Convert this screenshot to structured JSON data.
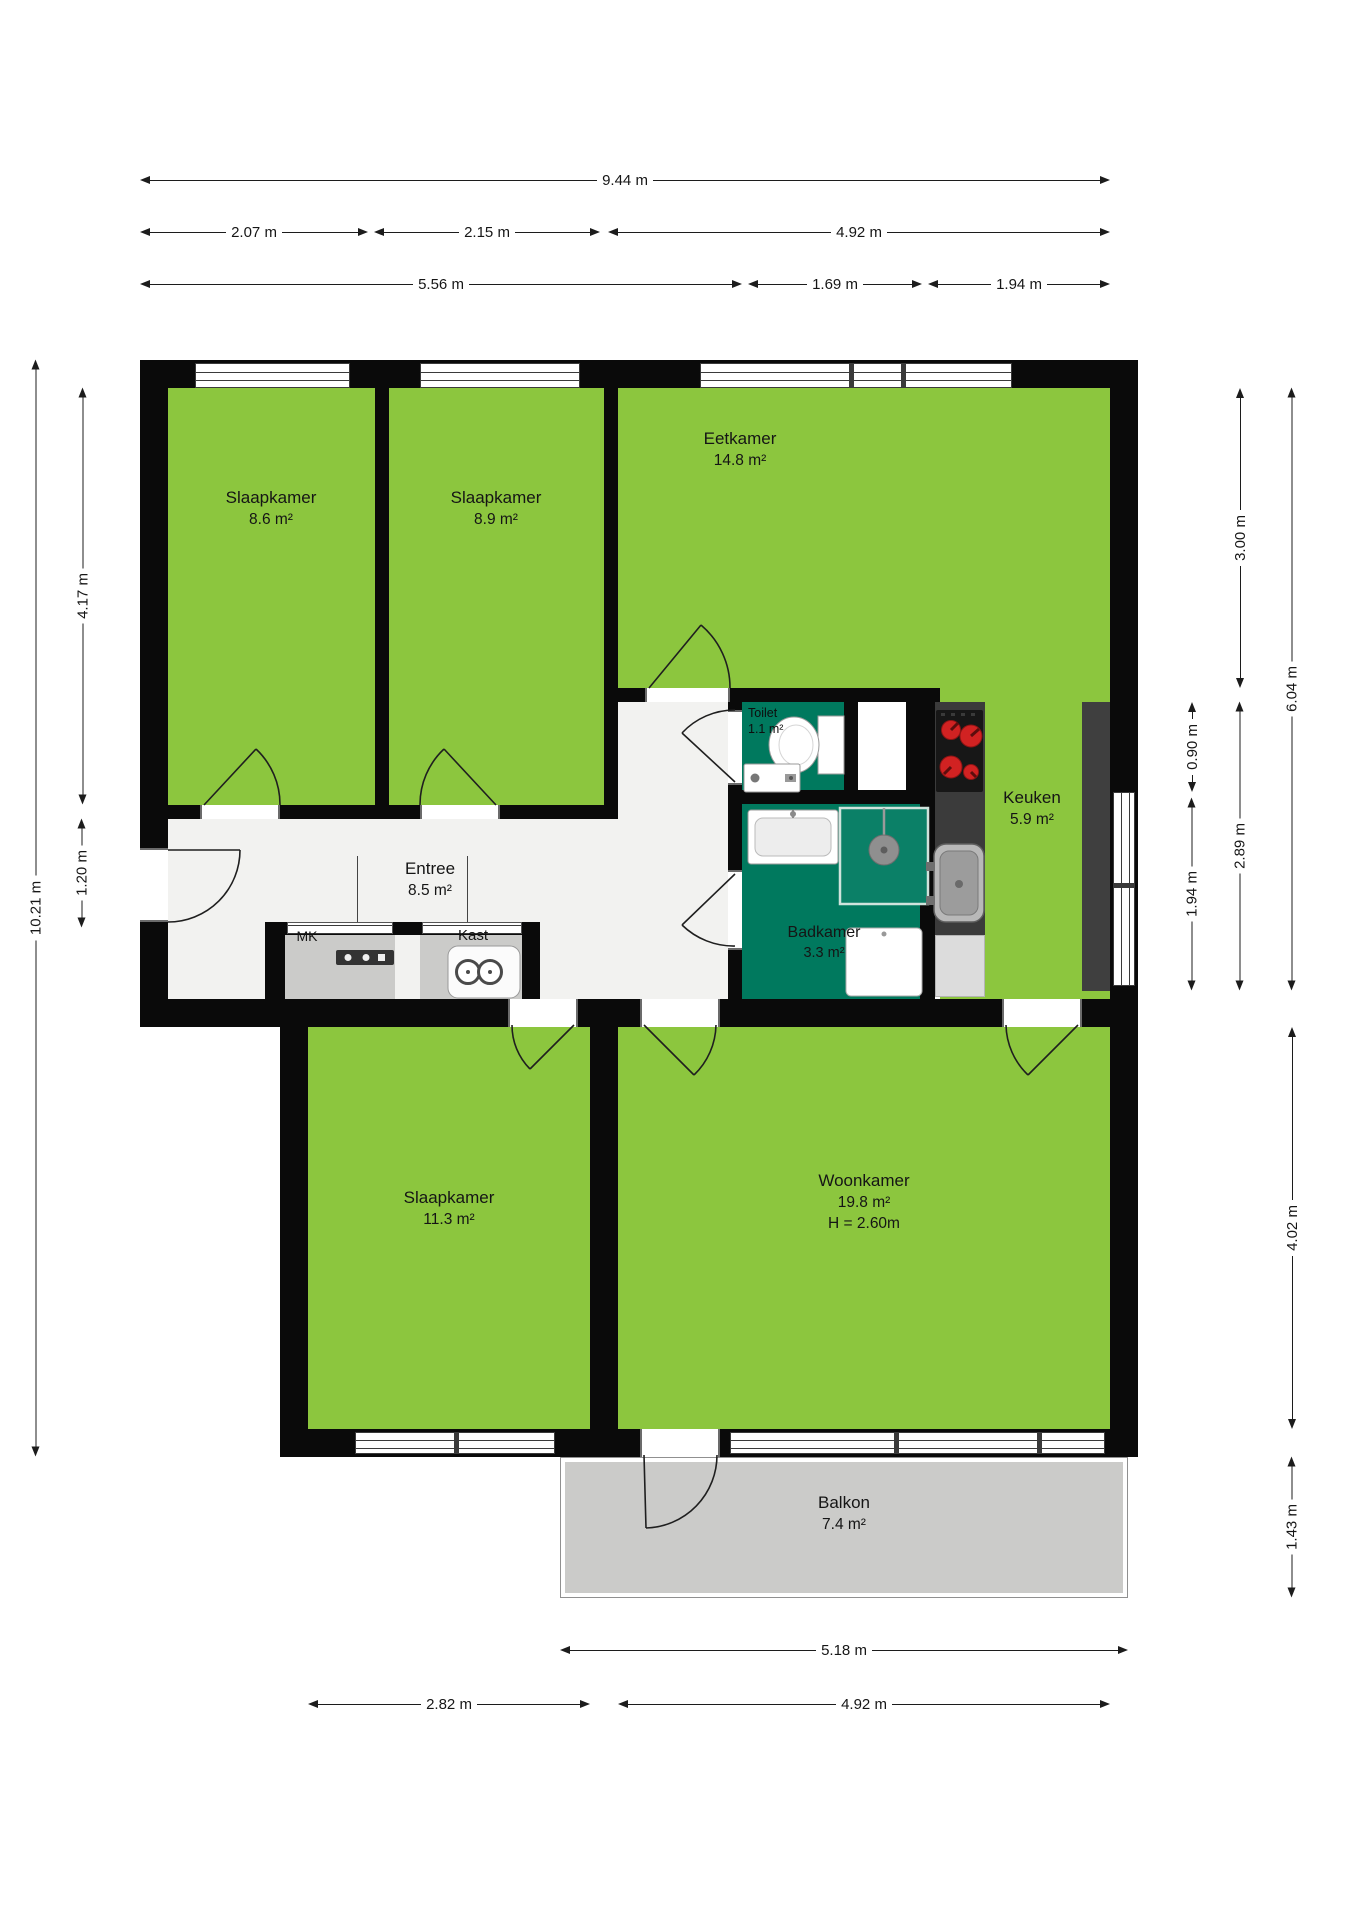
{
  "rooms": {
    "slaapkamer1": {
      "name": "Slaapkamer",
      "area": "8.6 m²"
    },
    "slaapkamer2": {
      "name": "Slaapkamer",
      "area": "8.9 m²"
    },
    "eetkamer": {
      "name": "Eetkamer",
      "area": "14.8 m²"
    },
    "toilet": {
      "name": "Toilet",
      "area": "1.1 m²"
    },
    "keuken": {
      "name": "Keuken",
      "area": "5.9 m²"
    },
    "entree": {
      "name": "Entree",
      "area": "8.5 m²"
    },
    "badkamer": {
      "name": "Badkamer",
      "area": "3.3 m²"
    },
    "mk": {
      "name": "MK"
    },
    "kast": {
      "name": "Kast"
    },
    "slaapkamer3": {
      "name": "Slaapkamer",
      "area": "11.3 m²"
    },
    "woonkamer": {
      "name": "Woonkamer",
      "area": "19.8 m²",
      "height": "H = 2.60m"
    },
    "balkon": {
      "name": "Balkon",
      "area": "7.4 m²"
    }
  },
  "dimensions": {
    "top_total": "9.44 m",
    "top_a": "2.07 m",
    "top_b": "2.15 m",
    "top_c": "4.92 m",
    "top_d": "5.56 m",
    "top_e": "1.69 m",
    "top_f": "1.94 m",
    "left_total": "10.21 m",
    "left_a": "4.17 m",
    "left_b": "1.20 m",
    "right_a": "3.00 m",
    "right_total": "6.04 m",
    "right_b": "0.90 m",
    "right_c": "2.89 m",
    "right_d": "1.94 m",
    "right_e": "4.02 m",
    "right_f": "1.43 m",
    "bottom_a": "5.18 m",
    "bottom_b": "2.82 m",
    "bottom_c": "4.92 m"
  },
  "colors": {
    "room_green": "#8CC63E",
    "wet_room_teal": "#00795E",
    "wall_black": "#0A0A0A",
    "balcony_gray": "#CBCBC9",
    "counter_dark": "#3B3B3B",
    "burner_red": "#D12222",
    "entree_floor": "#F2F2F0"
  }
}
